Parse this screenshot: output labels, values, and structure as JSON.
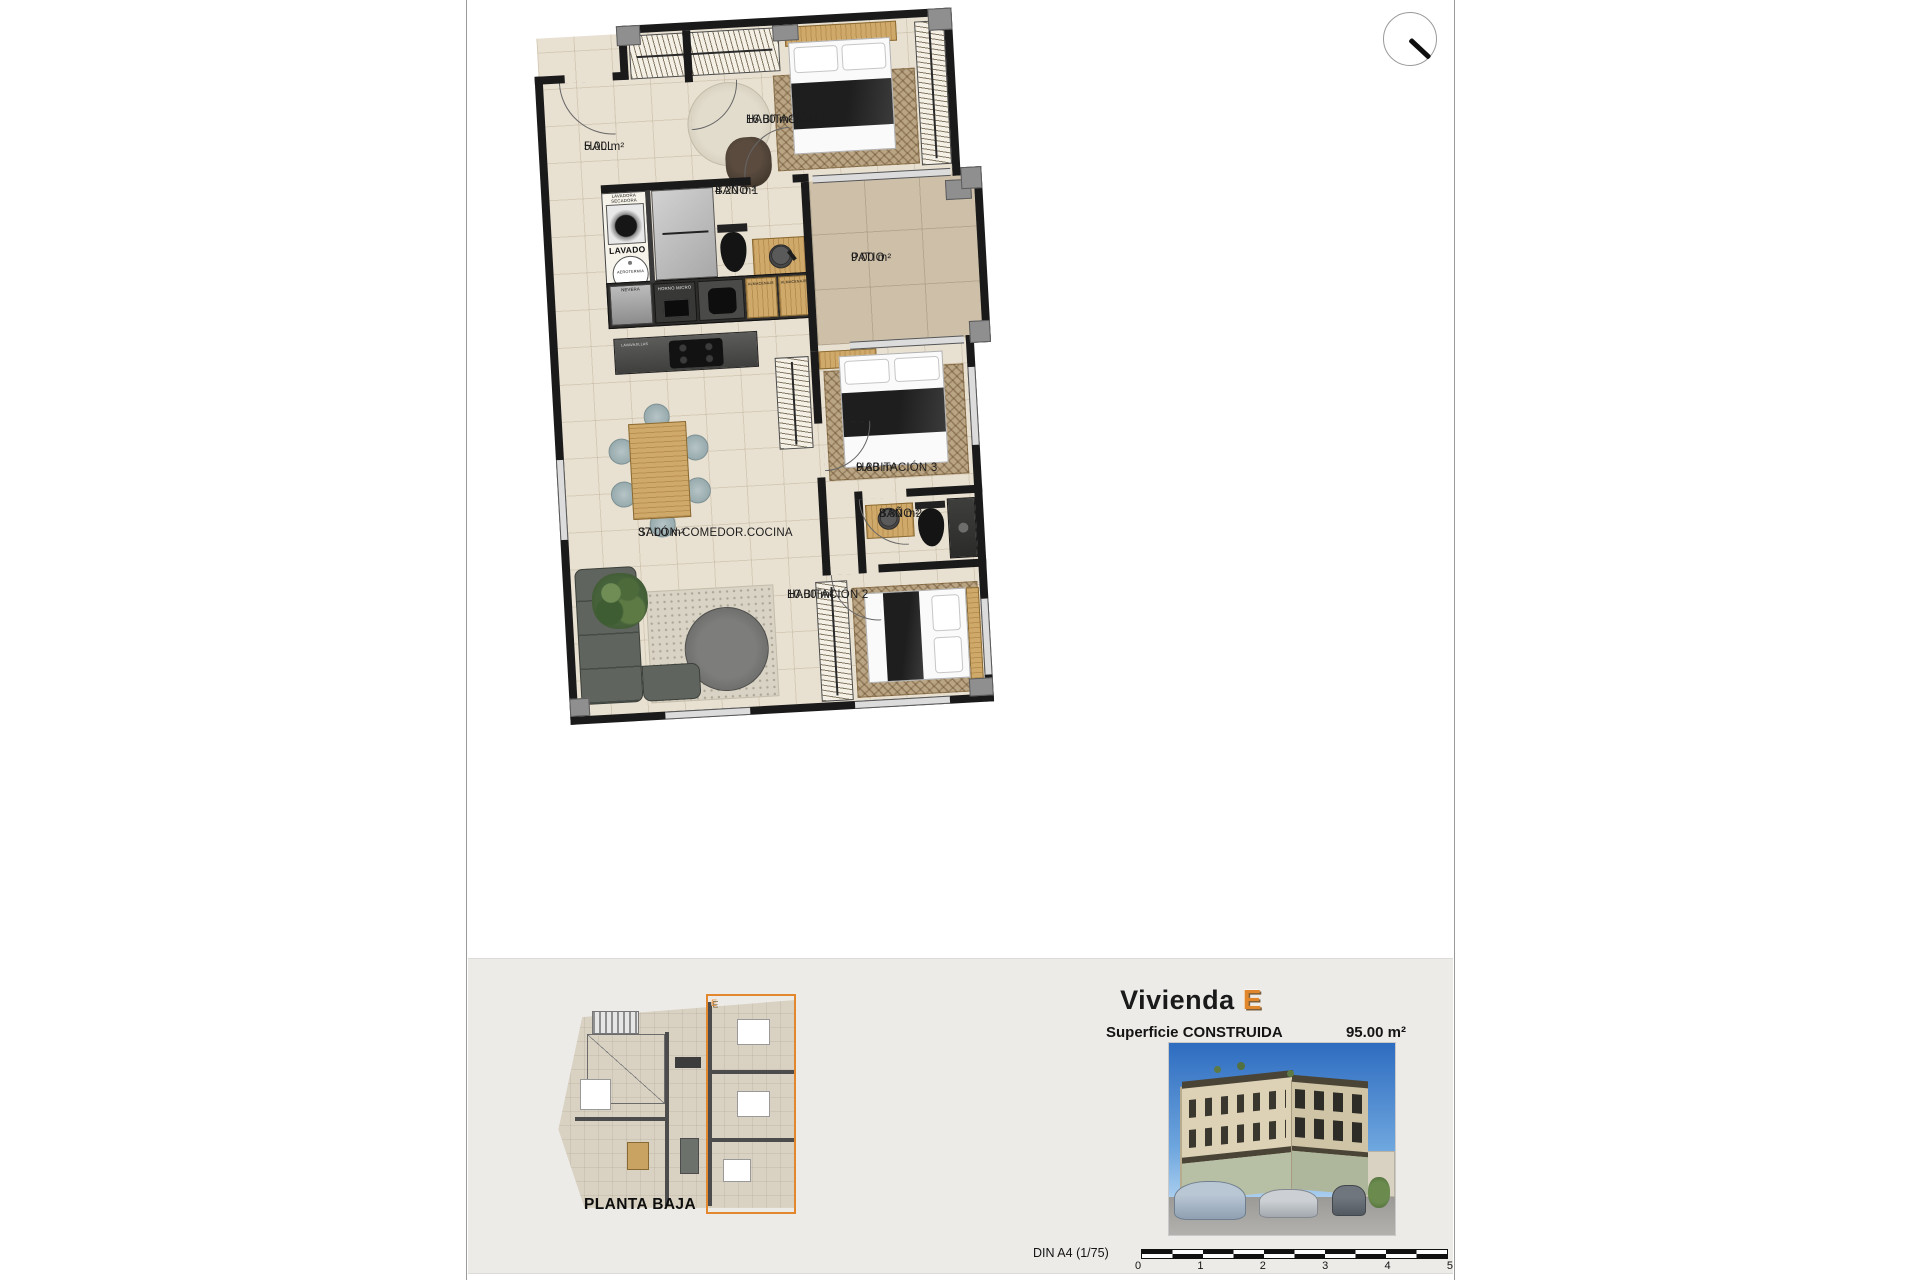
{
  "page": {
    "unit_badge": "E"
  },
  "north_indicator": "north-needle",
  "rooms": [
    {
      "name": "HALL",
      "area": "5.00 m²"
    },
    {
      "name": "HABITACIÓN 1",
      "area": "16.00 m²"
    },
    {
      "name": "BAÑO 1",
      "area": "4.20 m²"
    },
    {
      "name": "PATIO",
      "area": "9.00 m²"
    },
    {
      "name": "HABITACIÓN 3",
      "area": "9.80 m²"
    },
    {
      "name": "BAÑO 2",
      "area": "3.80 m²"
    },
    {
      "name": "HABITACIÓN 2",
      "area": "10.00 m²"
    },
    {
      "name": "SALÓN-COMEDOR.COCINA",
      "area": "37.00 m²"
    }
  ],
  "fixtures": {
    "lavadora_secadora": "LAVADORA SECADORA",
    "lavado": "LAVADO",
    "aerotermia": "AEROTERMIA",
    "nevera": "NEVERA",
    "horno_micro": "HORNO MICRO",
    "almacenaje_1": "ALMACENAJE",
    "almacenaje_2": "ALMACENAJE",
    "lavavajillas": "LAVAVAJILLAS"
  },
  "footer": {
    "plan_name": "PLANTA BAJA",
    "unit_title": "Vivienda",
    "unit_badge": "E",
    "surface_label": "Superficie CONSTRUIDA",
    "surface_value": "95.00 m²",
    "scale_label": "DIN A4 (1/75)",
    "scale_ticks": [
      "0",
      "1",
      "2",
      "3",
      "4",
      "5"
    ]
  },
  "colors": {
    "accent_orange": "#e0862c",
    "floor_beige": "#e8e0d1",
    "patio_tan": "#cdbfa8",
    "wall_black": "#1a1a1a",
    "panel_gray": "#ecebe8"
  }
}
